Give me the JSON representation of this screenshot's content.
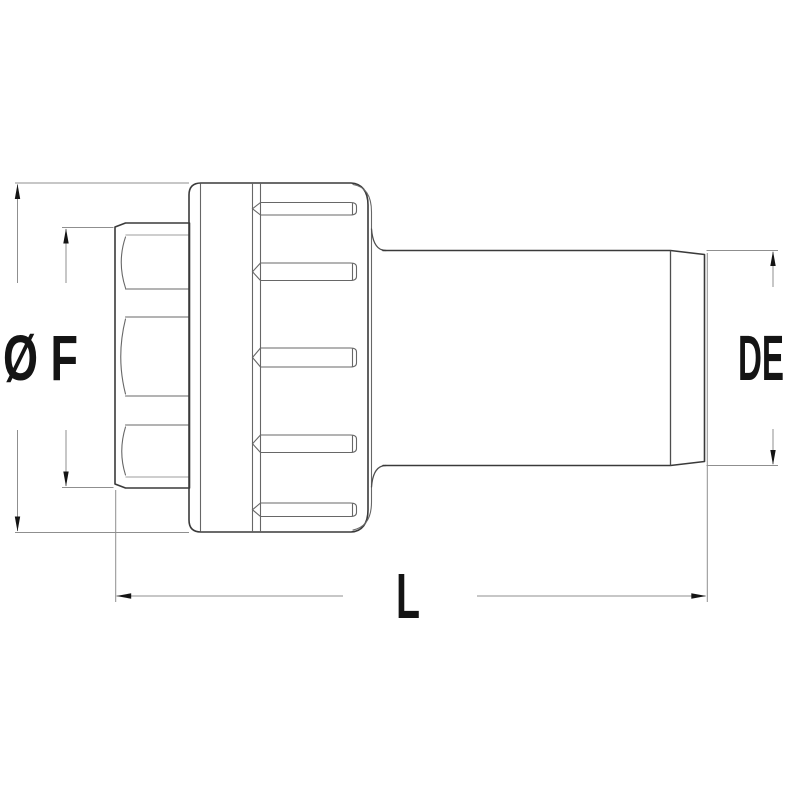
{
  "diagram": {
    "labels": {
      "f_diameter": "Ø F",
      "de_diameter": "DE",
      "length": "L"
    },
    "colors": {
      "background": "#ffffff",
      "outline": "#3a3a3a",
      "mid": "#4e4e4e",
      "detail": "#676767",
      "detail_light": "#9c9c9c",
      "dimension": "#8f8f8f",
      "text": "#141414"
    }
  }
}
